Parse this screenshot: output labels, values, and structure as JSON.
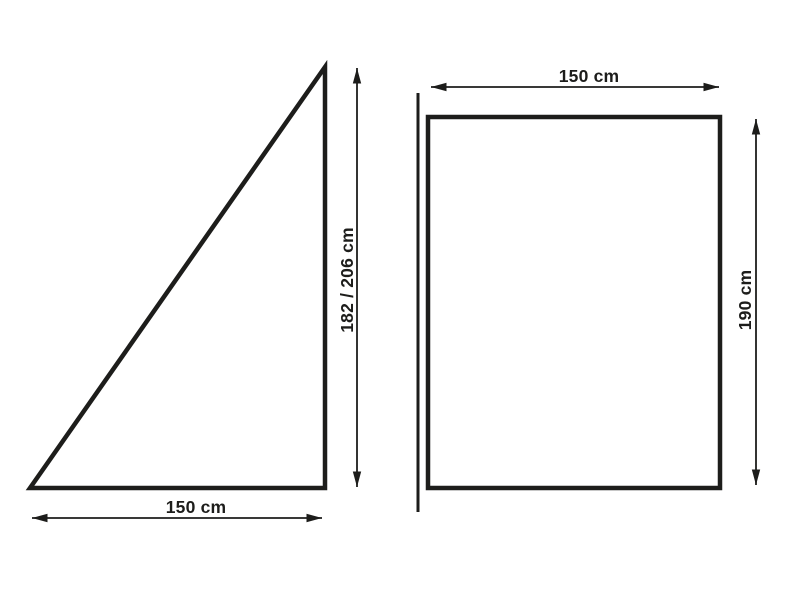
{
  "diagram": {
    "title": "panel-dimension-diagram",
    "background_color": "#ffffff",
    "line_color": "#1d1d1b",
    "left_panel": {
      "shape": "right-triangle",
      "height_label": "182 / 206 cm",
      "width_label": "150 cm"
    },
    "right_panel": {
      "shape": "rectangle",
      "width_label": "150 cm",
      "height_label": "190 cm"
    }
  }
}
